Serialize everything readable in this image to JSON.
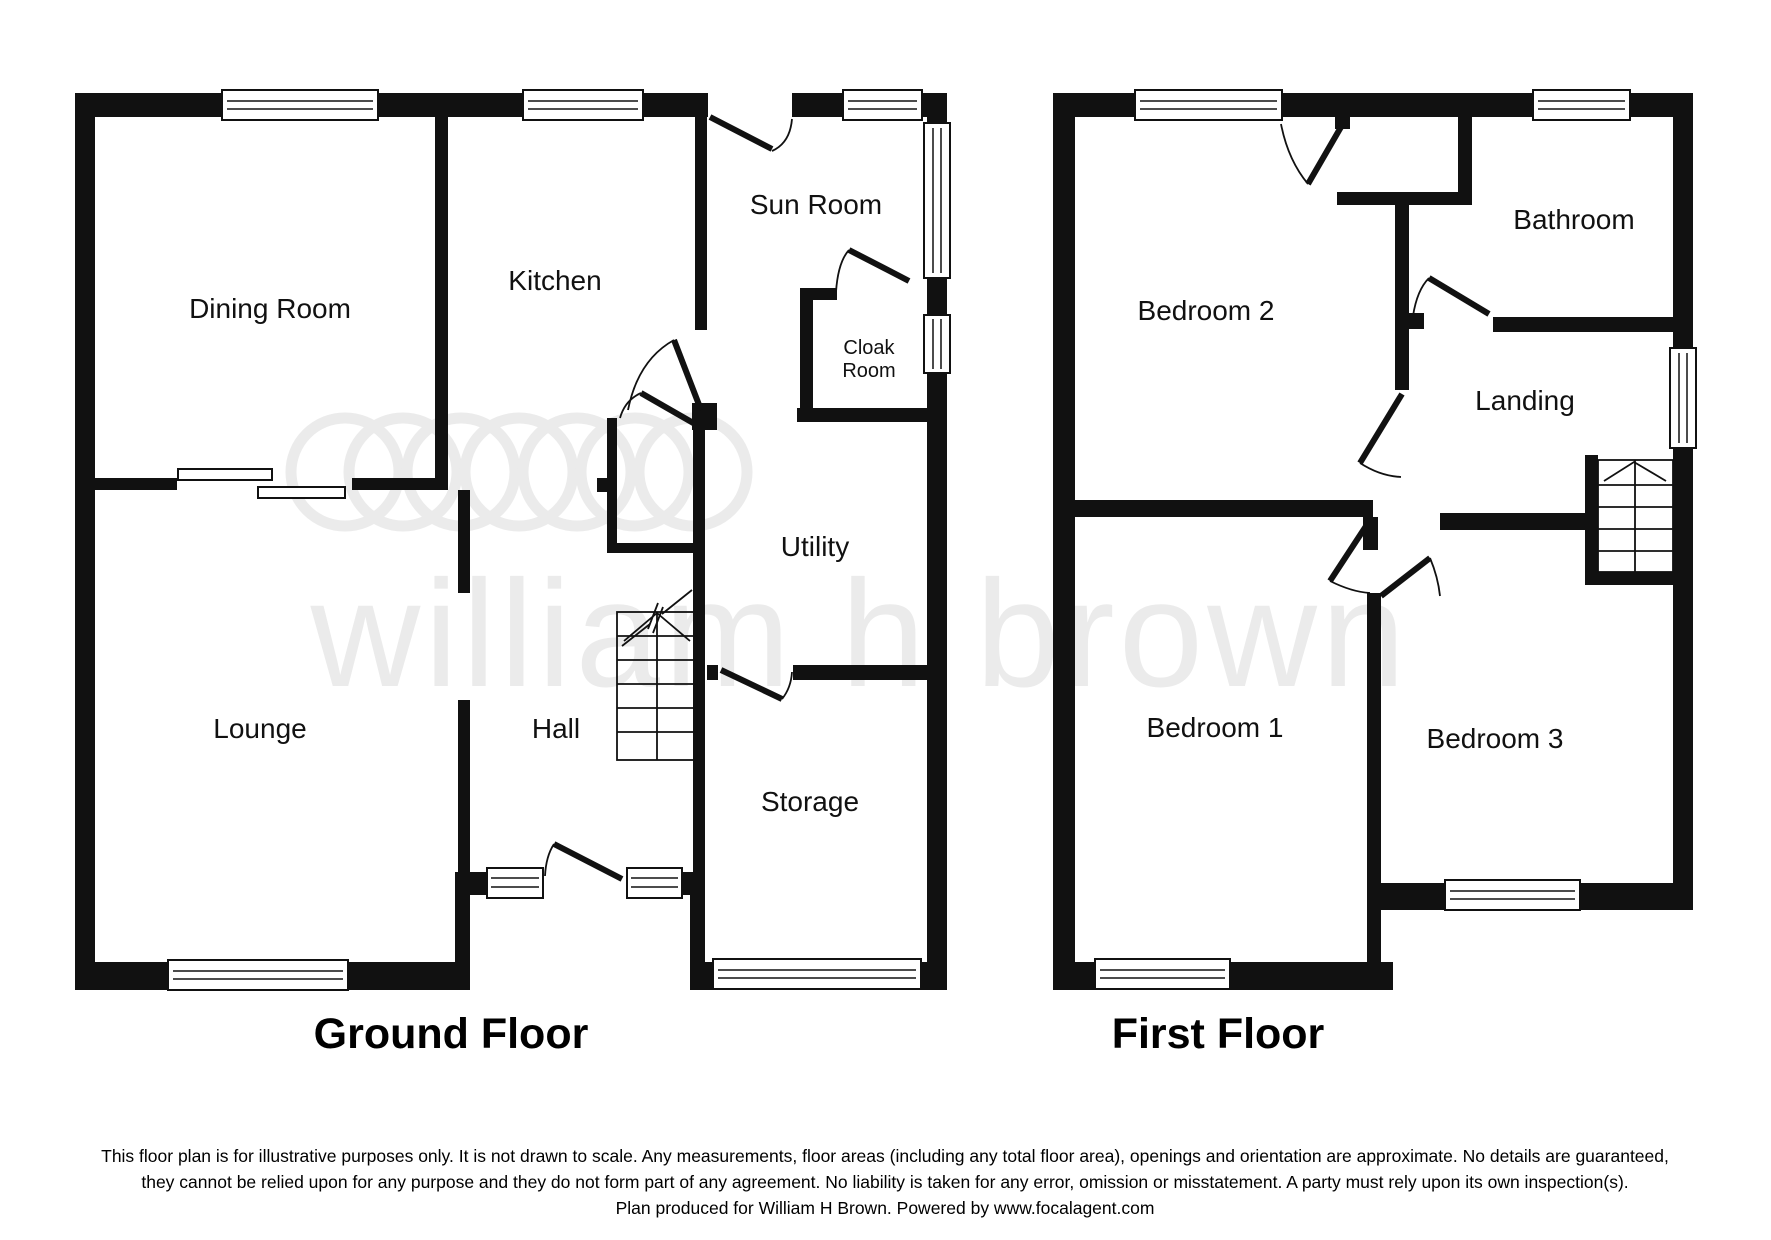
{
  "watermark": {
    "text": "william h brown"
  },
  "ground_floor": {
    "title": "Ground Floor",
    "rooms": {
      "dining": "Dining Room",
      "kitchen": "Kitchen",
      "sun": "Sun Room",
      "cloak_line1": "Cloak",
      "cloak_line2": "Room",
      "utility": "Utility",
      "lounge": "Lounge",
      "hall": "Hall",
      "storage": "Storage"
    }
  },
  "first_floor": {
    "title": "First Floor",
    "rooms": {
      "bed2": "Bedroom 2",
      "bath": "Bathroom",
      "landing": "Landing",
      "bed1": "Bedroom 1",
      "bed3": "Bedroom 3"
    }
  },
  "disclaimer": {
    "line1": "This floor plan is for illustrative purposes only. It is not drawn to scale. Any measurements, floor areas (including any total floor area), openings and orientation are approximate. No details are guaranteed,",
    "line2": "they cannot be relied upon for any purpose and they do not form part of any agreement. No liability is taken for any error, omission or misstatement. A party must rely upon its own inspection(s).",
    "line3": "Plan produced for William H Brown. Powered by www.focalagent.com"
  },
  "colors": {
    "wall": "#111111",
    "watermark": "#ebebeb",
    "background": "#ffffff"
  }
}
